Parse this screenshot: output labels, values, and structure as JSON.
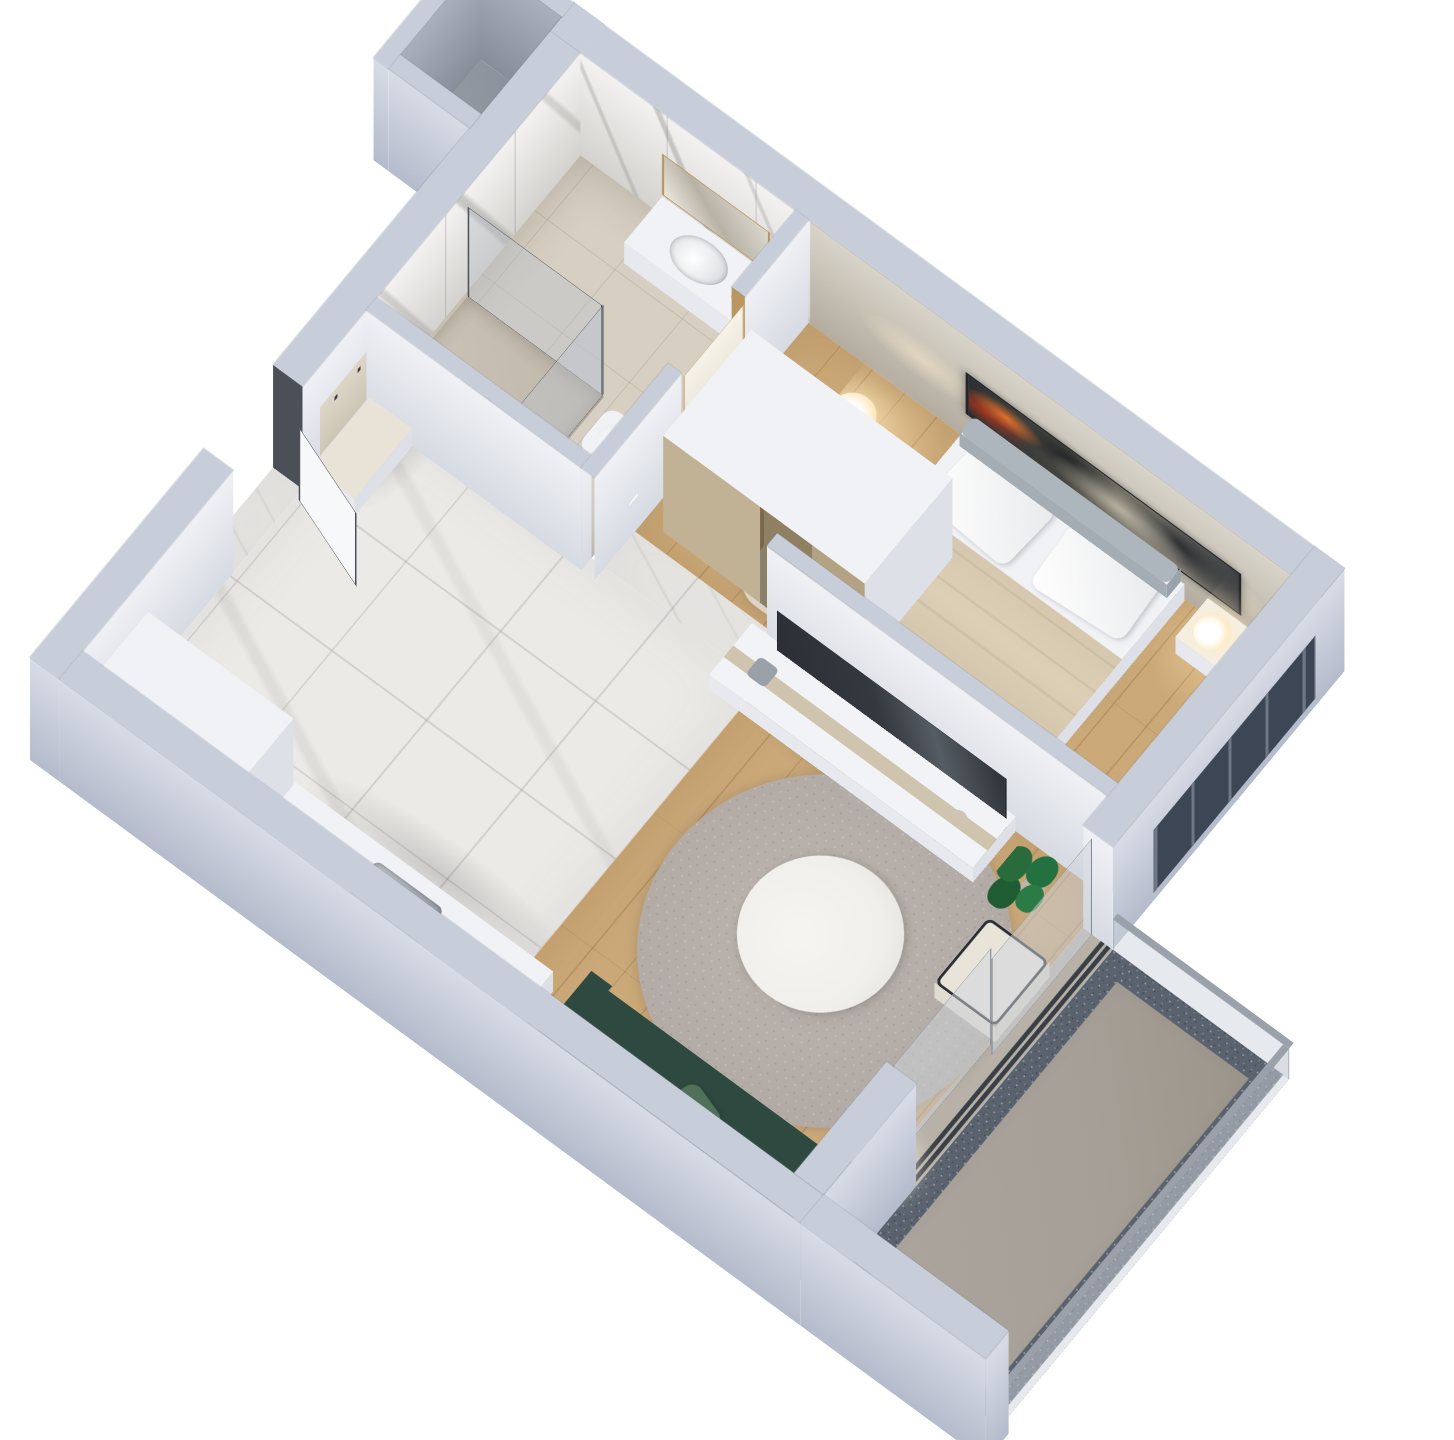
{
  "scene": {
    "title": "3D isometric floor plan render — one-bedroom apartment",
    "view": "axonometric dollhouse view from above, plan rotated about 52 degrees, white background",
    "rooms": [
      {
        "name": "bathroom",
        "floor": "beige ceramic tile",
        "walls": "white marble with gray veining",
        "features": [
          "walk-in shower with black-framed glass",
          "white toilet",
          "white vanity cabinet with basin",
          "gold-framed mirror",
          "white door with gold frame and black handle"
        ]
      },
      {
        "name": "hallway",
        "floor": "white marble tile",
        "features": [
          "entry door with dark gray frame shown open",
          "beige coat-rack wall panel with four hooks",
          "low white shoe cabinet",
          "light switches"
        ]
      },
      {
        "name": "kitchen",
        "floor": "white marble tile",
        "features": [
          "white counter along wall with stainless-steel sink",
          "tall white cabinet unit"
        ]
      },
      {
        "name": "living-room",
        "floor": "light oak plank",
        "features": [
          "dark green three-seat sofa with sage pillow",
          "round gray speckled rug",
          "round white coffee table",
          "long white TV sideboard with beige drawer",
          "flat-screen TV leaning on partition",
          "potted green plant",
          "cream armchair with black metal frame",
          "white globe floor lamp",
          "sliding glass door to balcony"
        ]
      },
      {
        "name": "bedroom",
        "floor": "light oak plank",
        "features": [
          "double bed with white pillows and beige throw",
          "gray upholstered headboard cushions",
          "panoramic dark artwork above bed",
          "white wardrobe with bronze mirror doors",
          "nightstand with lit table lamp",
          "globe floor lamp",
          "small beige rug",
          "window in facade wall"
        ]
      },
      {
        "name": "balcony",
        "floor": "gray concrete",
        "features": [
          "frameless glass railing",
          "dark gravel drainage border",
          "sliding-door threshold tracks"
        ]
      },
      {
        "name": "service-shaft",
        "floor": "concrete",
        "features": [
          "open duct enclosure attached to facade"
        ]
      }
    ]
  },
  "palette": {
    "bg": "#ffffff",
    "wallTop": "#c8ced9",
    "wallOuterLight": "#d8dce6",
    "wallOuterDark": "#b4bbcb",
    "wallInnerLight": "#f0f1f5",
    "wallInnerDark": "#d6dae2",
    "marbleFloor": "#eceae6",
    "bathFloor": "#d7cfc2",
    "wood": "#c8a471",
    "concrete": "#a59f97",
    "gravel": "#5a626e",
    "gravelDot": "#96a0ae",
    "rug": "#b2aba5",
    "sofa": "#2e4a40",
    "sofaDark": "#253c34",
    "sofaPillow": "#4f7059",
    "plant": "#2a6b3c",
    "tableTop": "#f1efeb",
    "tv": "#34383f",
    "glow": "#ffe2b0",
    "steel": "#b9bfc5",
    "doorFrame": "#4b5058",
    "gold": "#b99760"
  }
}
